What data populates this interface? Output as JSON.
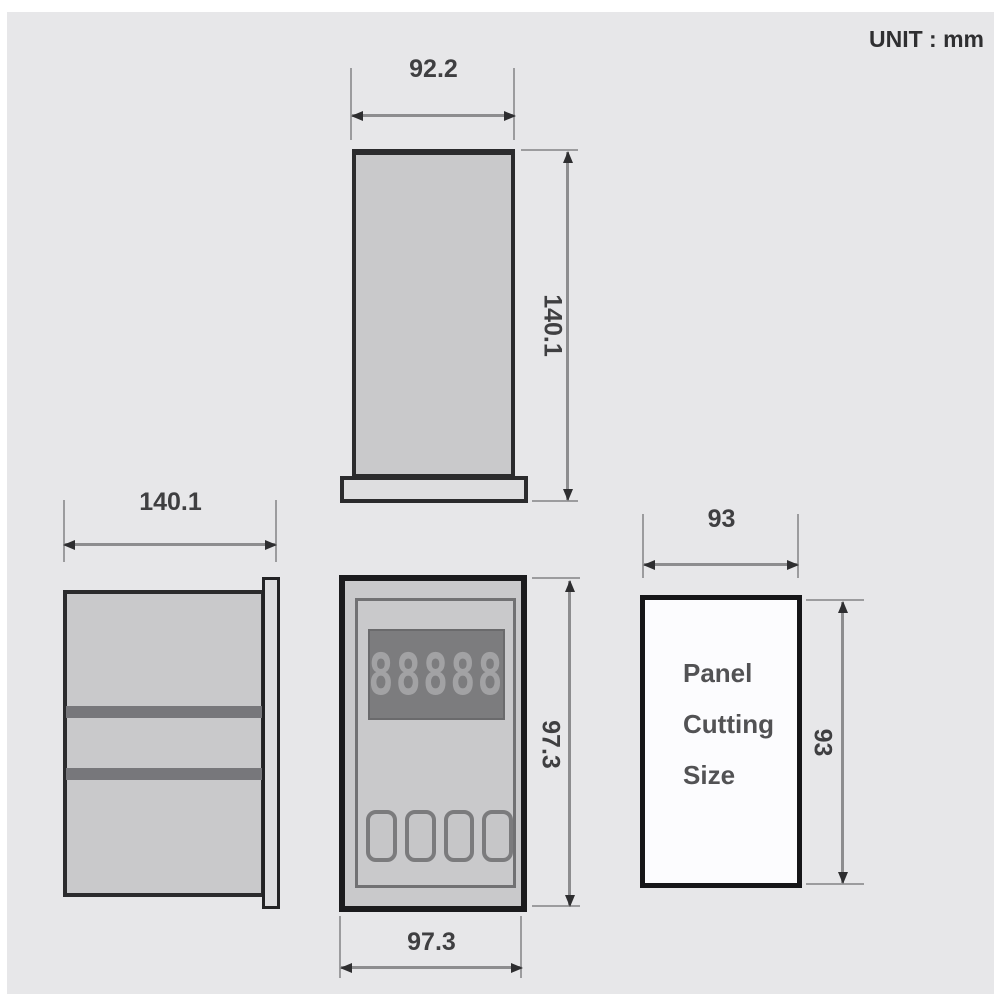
{
  "unit_label": "UNIT : mm",
  "display": {
    "digits": "88888"
  },
  "panel_cut_label": {
    "line1": "Panel",
    "line2": "Cutting",
    "line3": "Size"
  },
  "dimensions": {
    "top_width": "92.2",
    "top_depth": "140.1",
    "side_width": "140.1",
    "front_height": "97.3",
    "front_width": "97.3",
    "cut_width": "93",
    "cut_height": "93"
  },
  "colors": {
    "canvas": "#e7e7e9",
    "device_fill": "#c9c9cb",
    "outline": "#2b2b2d",
    "display_bg": "#7c7c7e",
    "display_digits": "#a2a2a4",
    "dim_line": "#8d8d8f",
    "text": "#3f3f41",
    "cutout_fill": "#fcfcfe"
  }
}
